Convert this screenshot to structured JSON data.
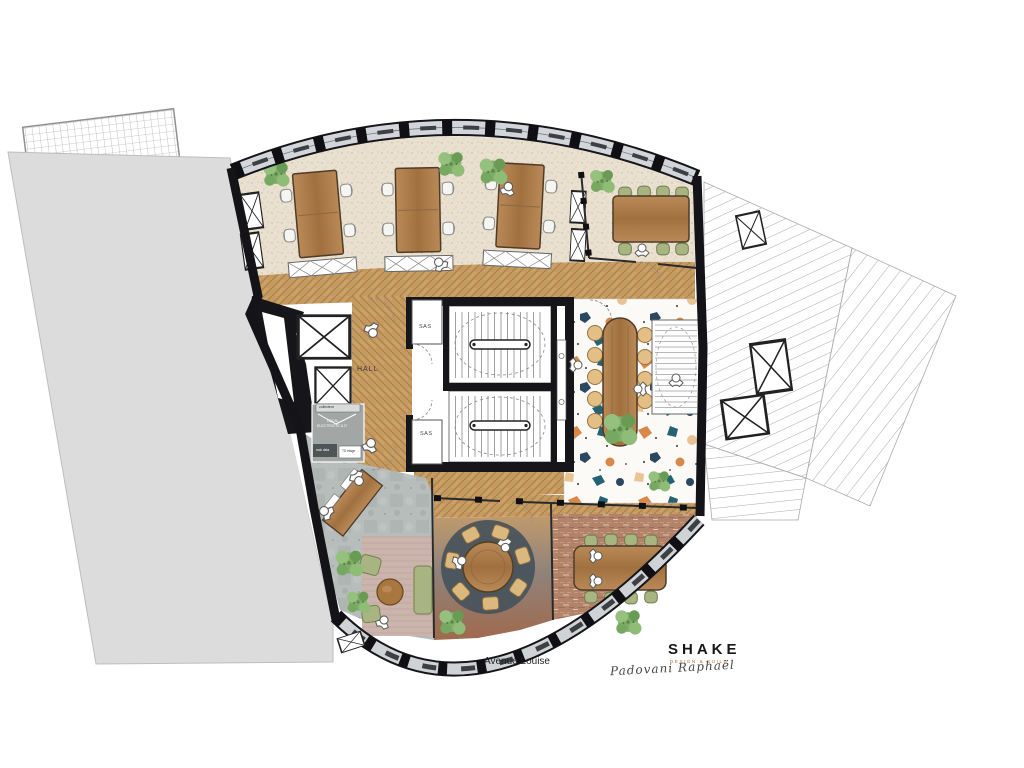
{
  "labels": {
    "hall": "HALL",
    "sas_top": "SAS",
    "sas_bottom": "SAS",
    "street": "Avenue Louise",
    "collecteur": "collecteur",
    "local_line1": "LOCAL",
    "local_line2": "ELECTRICITE & IT",
    "rack_data": "rack data",
    "td_etage": "TD étage"
  },
  "logo": {
    "name": "SHAKE",
    "tagline": "DESIGN & BUILD",
    "signature": "Padovani Raphaël"
  },
  "colors": {
    "wall": "#16161a",
    "glass": "#d2d5d9",
    "carpet_speckle": "#e9e0cf",
    "herringbone_wood": "#c59a61",
    "desk_wood": "#ad7c4c",
    "terrazzo_base": "#fbfaf7",
    "terrazzo_accents": [
      "#d9884a",
      "#256273",
      "#2c4760",
      "#eac392"
    ],
    "concrete": "#b7bdbb",
    "rug_pink": "#cbb4ab",
    "rug_dark": "#46525c",
    "brick_floor": "#b28269",
    "chair_green": "#a9b580",
    "chair_tan": "#e3be85",
    "plant_green": "#7fae69",
    "neighbor_gray": "#dcdcdd",
    "logo_accent": "#c0662b"
  }
}
